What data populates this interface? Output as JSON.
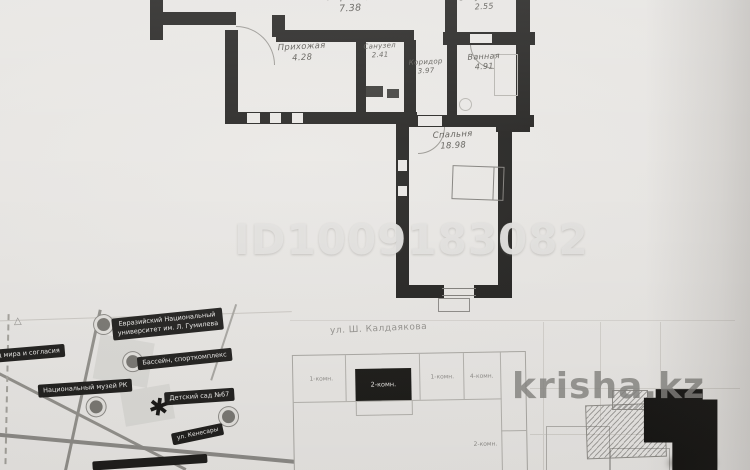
{
  "watermarks": {
    "listing_id": "ID1009183082",
    "site": "krisha.kz"
  },
  "colors": {
    "wall": "#1d1c1a",
    "paper": "#e9e7e4",
    "pill": "#1c1b19",
    "watermark": "#e4e3e0"
  },
  "floor_plan": {
    "rooms": {
      "koridor_top": {
        "name": "Коридор",
        "area": "7.38"
      },
      "prihozhaya": {
        "name": "Прихожая",
        "area": "4.28"
      },
      "sanuzel": {
        "name": "Санузел",
        "area": "2.41"
      },
      "koridor_small": {
        "name": "Коридор",
        "area": "3.97"
      },
      "vannaya": {
        "name": "Ванная",
        "area": "4.91"
      },
      "sanuzel2": {
        "name": "Сануз. 2-ой",
        "area": "2.55"
      },
      "spalnya": {
        "name": "Спальня",
        "area": "18.98"
      }
    }
  },
  "site_map": {
    "landmarks": [
      {
        "line1": "Евразийский Национальный",
        "line2": "университет им. Л. Гумилева"
      },
      {
        "line1": "Дворец мира и согласия"
      },
      {
        "line1": "Бассейн, спорткомплекс"
      },
      {
        "line1": "Национальный музей РК"
      },
      {
        "line1": "Детский сад №67"
      },
      {
        "line1": "ул. Кенесары"
      }
    ],
    "street_label": "ул. Ш. Калдаякова",
    "marker_glyph": "✱",
    "tree_glyph": "△"
  },
  "building_plan": {
    "units": [
      {
        "label": "1-комн."
      },
      {
        "label": "2-комн."
      },
      {
        "label": "1-комн."
      },
      {
        "label": "4-комн."
      },
      {
        "label": "2-комн."
      }
    ]
  }
}
